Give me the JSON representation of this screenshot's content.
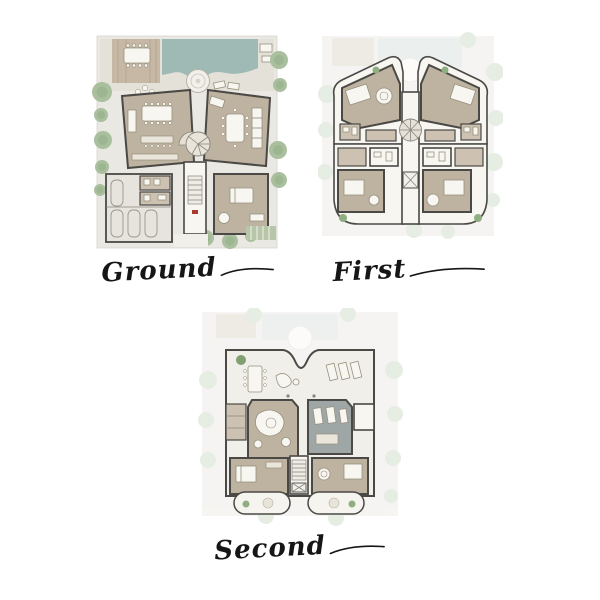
{
  "page": {
    "background": "#ffffff",
    "description": "Villa floor-plan presentation sheet with three storeys"
  },
  "plans": [
    {
      "id": "ground-floor-plan",
      "label": "Ground",
      "features": [
        "swimming-pool",
        "circular-spa",
        "sun-deck",
        "outdoor-dining-table",
        "lounge-dining-kitchen-wing",
        "majlis-dining-wing",
        "fan-stair",
        "garage-four-cars",
        "guest-suite",
        "garden-trees",
        "hedge",
        "driveway",
        "entry-marker"
      ]
    },
    {
      "id": "first-floor-plan",
      "label": "First",
      "features": [
        "four-bedroom-suites",
        "spiral-stair",
        "elevator",
        "dressing-rooms",
        "bathrooms",
        "curved-balconies",
        "planters",
        "ghost-site-underlay"
      ]
    },
    {
      "id": "second-floor-plan",
      "label": "Second",
      "features": [
        "roof-terrace",
        "terrace-dining-table",
        "sun-loungers",
        "planter",
        "family-lounge",
        "gym",
        "two-bedroom-suites",
        "stair",
        "elevator",
        "scalloped-balconies",
        "ghost-site-underlay"
      ]
    }
  ],
  "colors": {
    "background": "#ffffff",
    "site_base": "#eae8e2",
    "pool_teal": "#9fbab5",
    "deck_tan": "#c6b8a4",
    "room_floor_tan": "#beb2a0",
    "room_floor_light": "#cdc2b1",
    "gym_gray": "#9fa7a6",
    "terrace_ivory": "#f1efe9",
    "wall_charcoal": "#4a4945",
    "tree_green": "#a9bf9e",
    "plant_green": "#8fae81",
    "hedge_green": "#b7c5a8",
    "entry_red": "#a83a30",
    "label_ink": "#161616"
  },
  "icons": {
    "tree": "filled circle cluster",
    "spa": "concentric circles",
    "stair": "fan / ladder hatch",
    "elevator": "crossed box",
    "car": "rounded outline",
    "bed": "white rectangle with pillows",
    "table": "white rectangle with chair dots"
  }
}
